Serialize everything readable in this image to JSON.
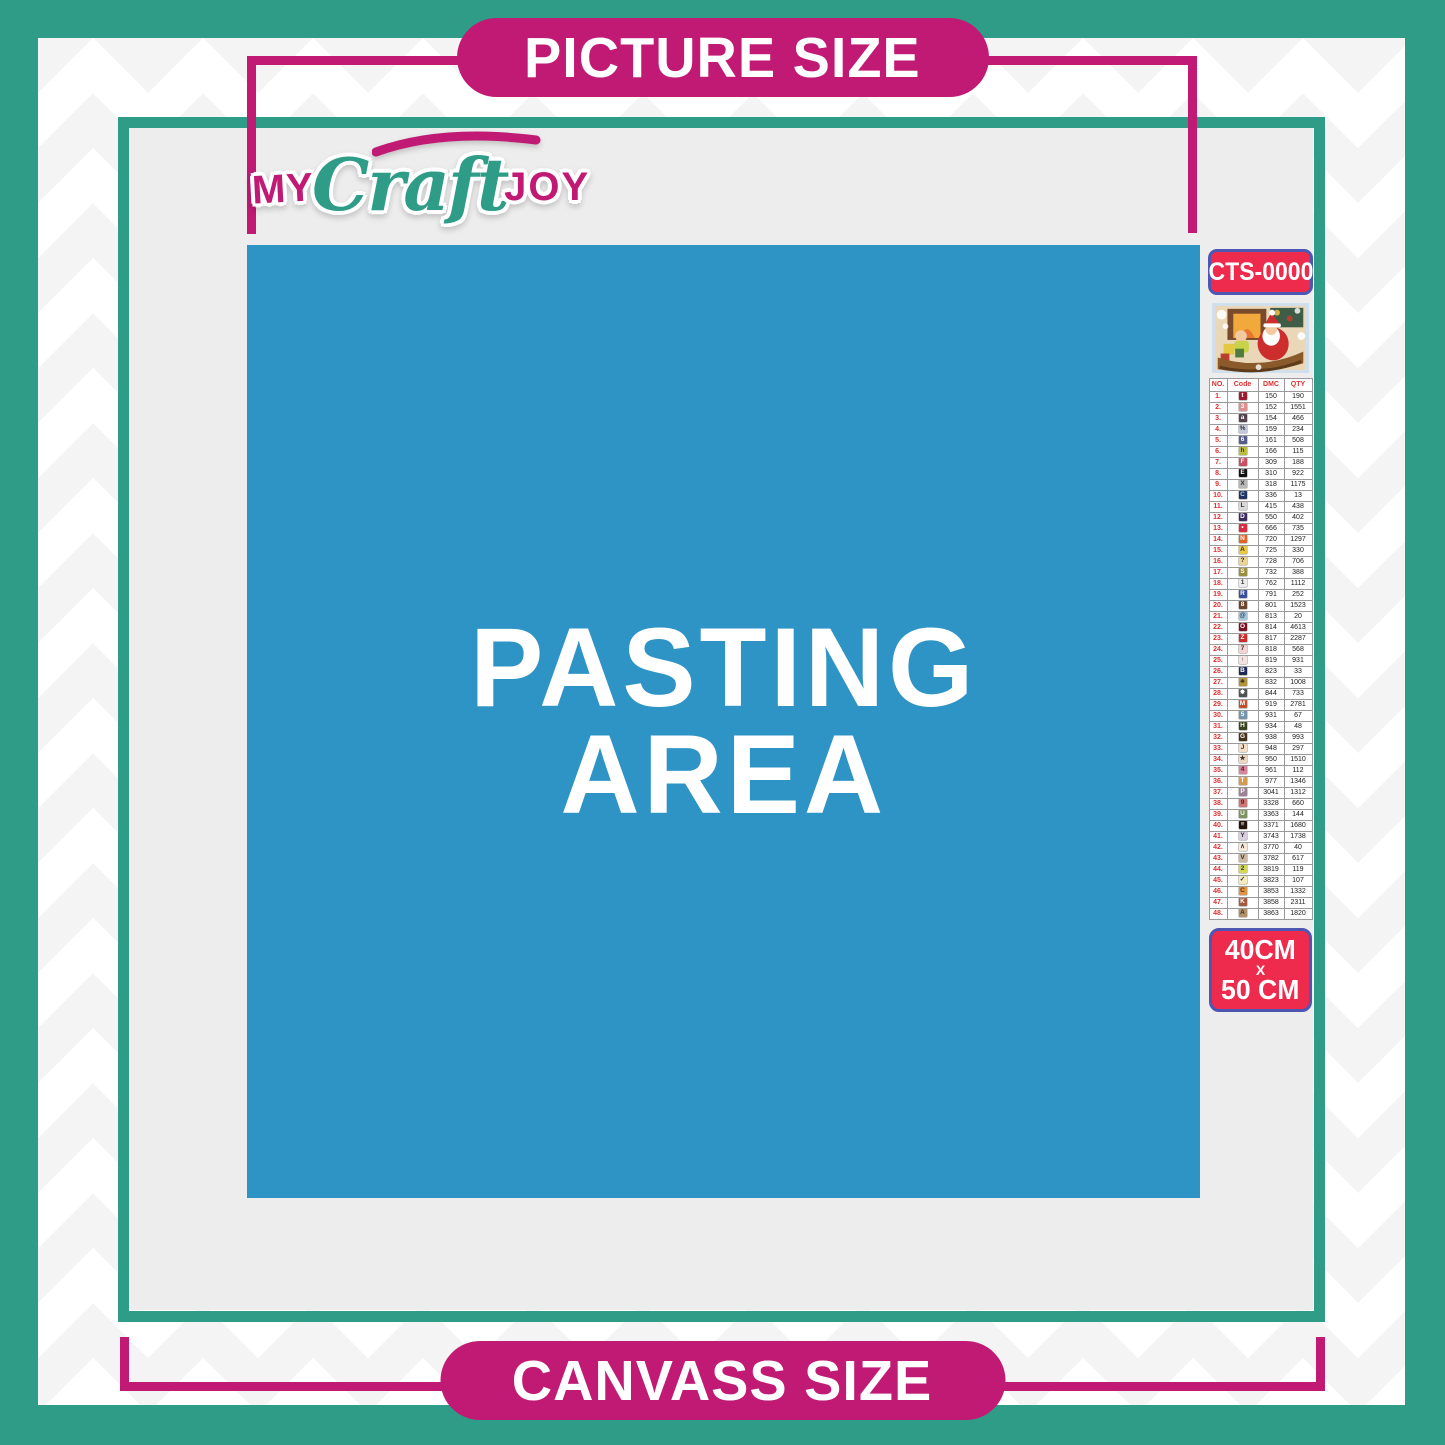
{
  "header": {
    "picture_size_label": "PICTURE SIZE"
  },
  "footer": {
    "canvass_size_label": "CANVASS SIZE"
  },
  "logo": {
    "my": "MY",
    "craft": "Craft",
    "joy": "JOY"
  },
  "pasting_area": {
    "line1": "PASTING",
    "line2": "AREA"
  },
  "sidebar": {
    "sku": "CTS-0000",
    "thumbnail": "christmas-santa-sleigh-artwork",
    "size": {
      "width_label": "40CM",
      "x_label": "X",
      "height_label": "50 CM"
    },
    "table": {
      "headers": [
        "NO.",
        "Code",
        "DMC",
        "QTY"
      ],
      "rows": [
        {
          "no": "1.",
          "symbol": "t",
          "symbol_bg": "#9b1b30",
          "symbol_fg": "#ffffff",
          "dmc": "150",
          "qty": "190"
        },
        {
          "no": "2.",
          "symbol": "3",
          "symbol_bg": "#e08e8e",
          "symbol_fg": "#ffffff",
          "dmc": "152",
          "qty": "1551"
        },
        {
          "no": "3.",
          "symbol": "a",
          "symbol_bg": "#56414f",
          "symbol_fg": "#ffffff",
          "dmc": "154",
          "qty": "466"
        },
        {
          "no": "4.",
          "symbol": "%",
          "symbol_bg": "#c5c9dc",
          "symbol_fg": "#333333",
          "dmc": "159",
          "qty": "234"
        },
        {
          "no": "5.",
          "symbol": "6",
          "symbol_bg": "#555c88",
          "symbol_fg": "#ffffff",
          "dmc": "161",
          "qty": "508"
        },
        {
          "no": "6.",
          "symbol": "h",
          "symbol_bg": "#bcbe3a",
          "symbol_fg": "#333333",
          "dmc": "166",
          "qty": "115"
        },
        {
          "no": "7.",
          "symbol": "F",
          "symbol_bg": "#c94f63",
          "symbol_fg": "#ffffff",
          "dmc": "309",
          "qty": "188"
        },
        {
          "no": "8.",
          "symbol": "E",
          "symbol_bg": "#111111",
          "symbol_fg": "#ffffff",
          "dmc": "310",
          "qty": "922"
        },
        {
          "no": "9.",
          "symbol": "X",
          "symbol_bg": "#b8b8b8",
          "symbol_fg": "#333333",
          "dmc": "318",
          "qty": "1175"
        },
        {
          "no": "10.",
          "symbol": "C",
          "symbol_bg": "#1f3461",
          "symbol_fg": "#bcd2f0",
          "dmc": "336",
          "qty": "13"
        },
        {
          "no": "11.",
          "symbol": "L",
          "symbol_bg": "#d8d8d8",
          "symbol_fg": "#333333",
          "dmc": "415",
          "qty": "438"
        },
        {
          "no": "12.",
          "symbol": "D",
          "symbol_bg": "#3d2a5e",
          "symbol_fg": "#ffffff",
          "dmc": "550",
          "qty": "402"
        },
        {
          "no": "13.",
          "symbol": "•",
          "symbol_bg": "#dc2b3c",
          "symbol_fg": "#ffffff",
          "dmc": "666",
          "qty": "735"
        },
        {
          "no": "14.",
          "symbol": "N",
          "symbol_bg": "#e2642a",
          "symbol_fg": "#ffffff",
          "dmc": "720",
          "qty": "1297"
        },
        {
          "no": "15.",
          "symbol": "A",
          "symbol_bg": "#e8c93f",
          "symbol_fg": "#333333",
          "dmc": "725",
          "qty": "330"
        },
        {
          "no": "16.",
          "symbol": "?",
          "symbol_bg": "#ecd592",
          "symbol_fg": "#333333",
          "dmc": "728",
          "qty": "706"
        },
        {
          "no": "17.",
          "symbol": "S",
          "symbol_bg": "#9a8f3d",
          "symbol_fg": "#ffffff",
          "dmc": "732",
          "qty": "388"
        },
        {
          "no": "18.",
          "symbol": "1",
          "symbol_bg": "#eeecec",
          "symbol_fg": "#333333",
          "dmc": "762",
          "qty": "1112"
        },
        {
          "no": "19.",
          "symbol": "R",
          "symbol_bg": "#3c4d9a",
          "symbol_fg": "#ffffff",
          "dmc": "791",
          "qty": "252"
        },
        {
          "no": "20.",
          "symbol": "8",
          "symbol_bg": "#6b4730",
          "symbol_fg": "#ffffff",
          "dmc": "801",
          "qty": "1523"
        },
        {
          "no": "21.",
          "symbol": "@",
          "symbol_bg": "#a5c6de",
          "symbol_fg": "#334455",
          "dmc": "813",
          "qty": "20"
        },
        {
          "no": "22.",
          "symbol": "O",
          "symbol_bg": "#7a1222",
          "symbol_fg": "#ffffff",
          "dmc": "814",
          "qty": "4613"
        },
        {
          "no": "23.",
          "symbol": "Z",
          "symbol_bg": "#cf2b2b",
          "symbol_fg": "#ffffff",
          "dmc": "817",
          "qty": "2287"
        },
        {
          "no": "24.",
          "symbol": "7",
          "symbol_bg": "#f6d3d3",
          "symbol_fg": "#333333",
          "dmc": "818",
          "qty": "568"
        },
        {
          "no": "25.",
          "symbol": "↑",
          "symbol_bg": "#f6e3e3",
          "symbol_fg": "#333333",
          "dmc": "819",
          "qty": "931"
        },
        {
          "no": "26.",
          "symbol": "B",
          "symbol_bg": "#1d2a55",
          "symbol_fg": "#ffffff",
          "dmc": "823",
          "qty": "33"
        },
        {
          "no": "27.",
          "symbol": "♣",
          "symbol_bg": "#b29336",
          "symbol_fg": "#333333",
          "dmc": "832",
          "qty": "1008"
        },
        {
          "no": "28.",
          "symbol": "✸",
          "symbol_bg": "#4f5450",
          "symbol_fg": "#ffffff",
          "dmc": "844",
          "qty": "733"
        },
        {
          "no": "29.",
          "symbol": "M",
          "symbol_bg": "#c2512b",
          "symbol_fg": "#ffffff",
          "dmc": "919",
          "qty": "2781"
        },
        {
          "no": "30.",
          "symbol": "5",
          "symbol_bg": "#7495aa",
          "symbol_fg": "#ffffff",
          "dmc": "931",
          "qty": "67"
        },
        {
          "no": "31.",
          "symbol": "H",
          "symbol_bg": "#39441f",
          "symbol_fg": "#ffffff",
          "dmc": "934",
          "qty": "48"
        },
        {
          "no": "32.",
          "symbol": "G",
          "symbol_bg": "#45301a",
          "symbol_fg": "#ffffff",
          "dmc": "938",
          "qty": "993"
        },
        {
          "no": "33.",
          "symbol": "J",
          "symbol_bg": "#f7ddc8",
          "symbol_fg": "#333333",
          "dmc": "948",
          "qty": "297"
        },
        {
          "no": "34.",
          "symbol": "★",
          "symbol_bg": "#efd9c0",
          "symbol_fg": "#333333",
          "dmc": "950",
          "qty": "1510"
        },
        {
          "no": "35.",
          "symbol": "4",
          "symbol_bg": "#d9849b",
          "symbol_fg": "#5a2030",
          "dmc": "961",
          "qty": "112"
        },
        {
          "no": "36.",
          "symbol": "T",
          "symbol_bg": "#d59a4e",
          "symbol_fg": "#ffffff",
          "dmc": "977",
          "qty": "1346"
        },
        {
          "no": "37.",
          "symbol": "P",
          "symbol_bg": "#9b8294",
          "symbol_fg": "#ffffff",
          "dmc": "3041",
          "qty": "1312"
        },
        {
          "no": "38.",
          "symbol": "9",
          "symbol_bg": "#cd7878",
          "symbol_fg": "#5a2020",
          "dmc": "3328",
          "qty": "660"
        },
        {
          "no": "39.",
          "symbol": "U",
          "symbol_bg": "#7d9161",
          "symbol_fg": "#ffffff",
          "dmc": "3363",
          "qty": "144"
        },
        {
          "no": "40.",
          "symbol": "≡",
          "symbol_bg": "#221409",
          "symbol_fg": "#ffffff",
          "dmc": "3371",
          "qty": "1680"
        },
        {
          "no": "41.",
          "symbol": "Y",
          "symbol_bg": "#d9cede",
          "symbol_fg": "#333333",
          "dmc": "3743",
          "qty": "1738"
        },
        {
          "no": "42.",
          "symbol": "∧",
          "symbol_bg": "#f8e8d8",
          "symbol_fg": "#333333",
          "dmc": "3770",
          "qty": "40"
        },
        {
          "no": "43.",
          "symbol": "V",
          "symbol_bg": "#cbb89f",
          "symbol_fg": "#333333",
          "dmc": "3782",
          "qty": "617"
        },
        {
          "no": "44.",
          "symbol": "2",
          "symbol_bg": "#d5d855",
          "symbol_fg": "#333333",
          "dmc": "3819",
          "qty": "119"
        },
        {
          "no": "45.",
          "symbol": "✓",
          "symbol_bg": "#f3ecbe",
          "symbol_fg": "#333333",
          "dmc": "3823",
          "qty": "107"
        },
        {
          "no": "46.",
          "symbol": "C",
          "symbol_bg": "#df9442",
          "symbol_fg": "#5a3610",
          "dmc": "3853",
          "qty": "1332"
        },
        {
          "no": "47.",
          "symbol": "K",
          "symbol_bg": "#a55a40",
          "symbol_fg": "#ffffff",
          "dmc": "3858",
          "qty": "2311"
        },
        {
          "no": "48.",
          "symbol": "A",
          "symbol_bg": "#b39267",
          "symbol_fg": "#333333",
          "dmc": "3863",
          "qty": "1820"
        }
      ]
    }
  },
  "colors": {
    "teal": "#2f9c87",
    "magenta": "#c11a74",
    "blue": "#2e93c5",
    "gray-bg": "#ededed",
    "crimson": "#ee2b4c",
    "box-border": "#4c57b4",
    "table-red": "#e03030"
  }
}
